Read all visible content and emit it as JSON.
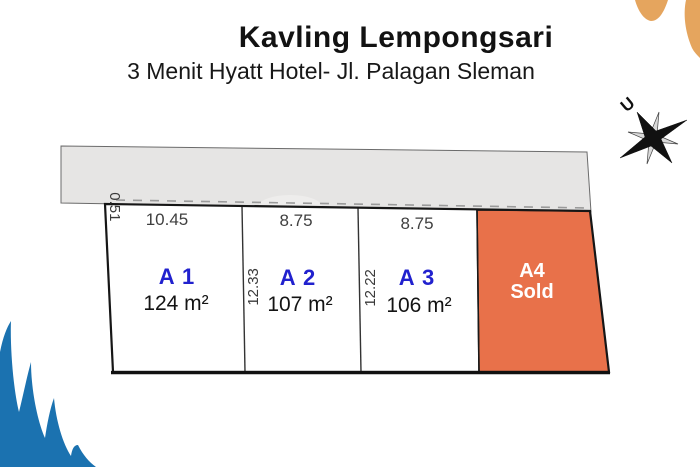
{
  "header": {
    "title": "Kavling Lempongsari",
    "subtitle": "3 Menit Hyatt Hotel- Jl. Palagan Sleman"
  },
  "compass": {
    "north_label": "U"
  },
  "site_plan": {
    "road_offset_label": "0.51",
    "plots": [
      {
        "name": "A 1",
        "area": "124 m²",
        "width_label": "10.45"
      },
      {
        "name": "A 2",
        "area": "107 m²",
        "width_label": "8.75",
        "depth_label": "12.33"
      },
      {
        "name": "A 3",
        "area": "106 m²",
        "width_label": "8.75",
        "depth_label": "12.22"
      },
      {
        "name": "A4",
        "status": "Sold"
      }
    ]
  },
  "colors": {
    "sold_plot": "#E8714A",
    "plot_label_blue": "#2121CE",
    "road_gray": "#E6E5E4",
    "decoration_blue": "#1B72B0",
    "decoration_sand": "#E5A55E"
  }
}
